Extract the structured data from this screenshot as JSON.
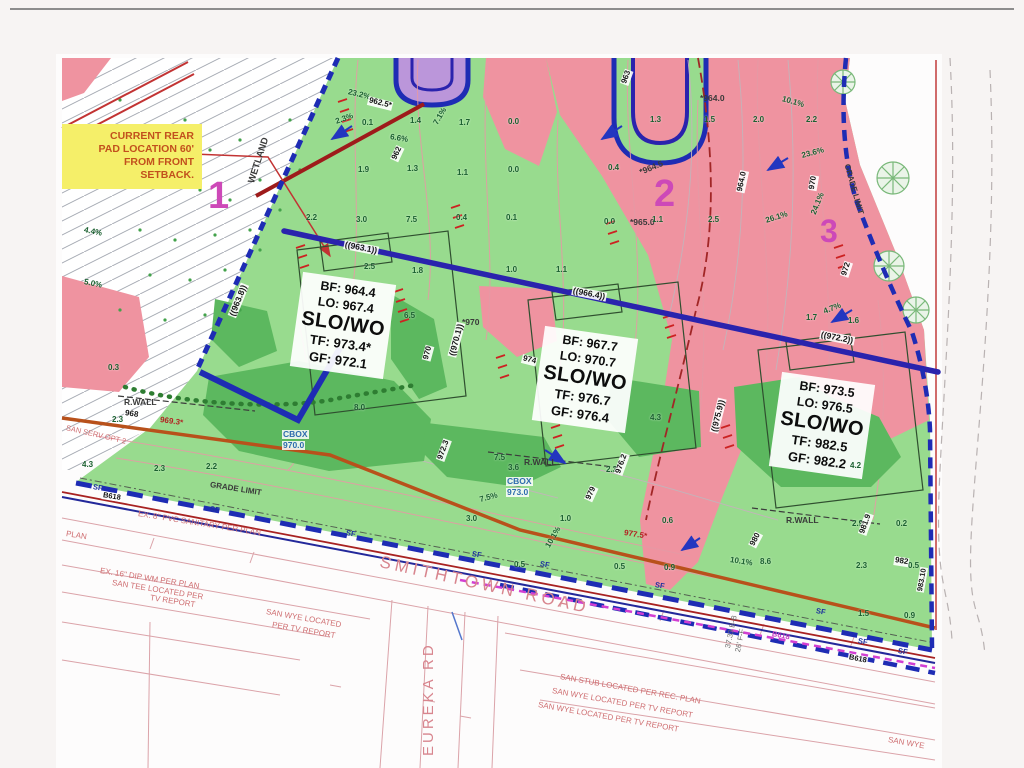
{
  "callout": {
    "lines": [
      "CURRENT REAR",
      "PAD LOCATION 60'",
      "FROM FRONT",
      "SETBACK."
    ]
  },
  "roads": {
    "smithtown": "SMITHTOWN ROAD",
    "eureka": "EUREKA RD"
  },
  "pads": [
    {
      "bf": "BF: 964.4",
      "lo": "LO: 967.4",
      "slo": "SLO/WO",
      "tf": "TF: 973.4*",
      "gf": "GF: 972.1"
    },
    {
      "bf": "BF: 967.7",
      "lo": "LO: 970.7",
      "slo": "SLO/WO",
      "tf": "TF: 976.7",
      "gf": "GF: 976.4"
    },
    {
      "bf": "BF: 973.5",
      "lo": "LO: 976.5",
      "slo": "SLO/WO",
      "tf": "TF: 982.5",
      "gf": "GF: 982.2"
    }
  ],
  "colors": {
    "site_green": "#98db8e",
    "cut_fill_pink": "#ef93a0",
    "boundary_blue": "#1e2cb4",
    "callout_yellow": "#f5ef69",
    "lot_magenta": "#cd49b8",
    "road_pink": "#d8858e"
  },
  "annotations": [
    {
      "t": "WETLAND",
      "x": 252,
      "y": 178,
      "r": -72,
      "c": "dark",
      "s": 9.5
    },
    {
      "t": "4.4%",
      "x": 84,
      "y": 226,
      "r": 12,
      "c": "num"
    },
    {
      "t": "5.0%",
      "x": 84,
      "y": 278,
      "r": 12,
      "c": "num"
    },
    {
      "t": "23.2%",
      "x": 348,
      "y": 88,
      "r": 14,
      "c": "num"
    },
    {
      "t": "962.5*",
      "x": 368,
      "y": 96,
      "r": 14,
      "c": "white"
    },
    {
      "t": "2.3%",
      "x": 336,
      "y": 118,
      "r": -20,
      "c": "num"
    },
    {
      "t": "0.1",
      "x": 362,
      "y": 119,
      "c": "num"
    },
    {
      "t": "1.4",
      "x": 410,
      "y": 117,
      "c": "num"
    },
    {
      "t": "7.1%",
      "x": 436,
      "y": 120,
      "r": -60,
      "c": "num"
    },
    {
      "t": "1.7",
      "x": 459,
      "y": 119,
      "c": "num"
    },
    {
      "t": "6.6%",
      "x": 390,
      "y": 133,
      "r": 10,
      "c": "num"
    },
    {
      "t": "962",
      "x": 394,
      "y": 156,
      "r": -65,
      "c": "white"
    },
    {
      "t": "1.9",
      "x": 358,
      "y": 166,
      "c": "num"
    },
    {
      "t": "1.3",
      "x": 407,
      "y": 165,
      "c": "num"
    },
    {
      "t": "1.1",
      "x": 457,
      "y": 169,
      "c": "num"
    },
    {
      "t": "0.0",
      "x": 508,
      "y": 118,
      "c": "num"
    },
    {
      "t": "0.0",
      "x": 508,
      "y": 166,
      "c": "num"
    },
    {
      "t": "1",
      "x": 208,
      "y": 176,
      "c": "lot",
      "s": 38
    },
    {
      "t": "963",
      "x": 624,
      "y": 80,
      "r": -70,
      "c": "white"
    },
    {
      "t": "*964.0",
      "x": 700,
      "y": 94,
      "c": "dark"
    },
    {
      "t": "10.1%",
      "x": 782,
      "y": 95,
      "r": 16,
      "c": "num"
    },
    {
      "t": "1.3",
      "x": 650,
      "y": 116,
      "c": "num"
    },
    {
      "t": "1.5",
      "x": 704,
      "y": 116,
      "c": "num"
    },
    {
      "t": "2.0",
      "x": 753,
      "y": 116,
      "c": "num"
    },
    {
      "t": "2.2",
      "x": 806,
      "y": 116,
      "c": "num"
    },
    {
      "t": "*964.5",
      "x": 640,
      "y": 168,
      "r": -22,
      "c": "dark"
    },
    {
      "t": "964.0",
      "x": 740,
      "y": 188,
      "r": -78,
      "c": "white"
    },
    {
      "t": "970",
      "x": 812,
      "y": 186,
      "r": -80,
      "c": "white"
    },
    {
      "t": "23.6%",
      "x": 802,
      "y": 152,
      "r": -15,
      "c": "num"
    },
    {
      "t": "0.4",
      "x": 608,
      "y": 164,
      "c": "num"
    },
    {
      "t": "2",
      "x": 654,
      "y": 174,
      "c": "lot",
      "s": 38
    },
    {
      "t": "*965.0",
      "x": 630,
      "y": 218,
      "c": "dark"
    },
    {
      "t": "0.0",
      "x": 604,
      "y": 218,
      "c": "num"
    },
    {
      "t": "1.1",
      "x": 652,
      "y": 216,
      "c": "num"
    },
    {
      "t": "2.5",
      "x": 708,
      "y": 216,
      "c": "num"
    },
    {
      "t": "26.1%",
      "x": 766,
      "y": 217,
      "r": -18,
      "c": "num"
    },
    {
      "t": "24.1%",
      "x": 814,
      "y": 210,
      "r": -68,
      "c": "num"
    },
    {
      "t": "3",
      "x": 820,
      "y": 214,
      "c": "lot",
      "s": 32
    },
    {
      "t": "972",
      "x": 844,
      "y": 272,
      "r": -72,
      "c": "white"
    },
    {
      "t": "GRADE LIMIT",
      "x": 846,
      "y": 160,
      "r": 74,
      "c": "dark",
      "s": 8
    },
    {
      "t": "2.2",
      "x": 306,
      "y": 214,
      "c": "num"
    },
    {
      "t": "3.0",
      "x": 356,
      "y": 216,
      "c": "num"
    },
    {
      "t": "7.5",
      "x": 406,
      "y": 216,
      "c": "num"
    },
    {
      "t": "0.4",
      "x": 456,
      "y": 214,
      "c": "num"
    },
    {
      "t": "0.1",
      "x": 506,
      "y": 214,
      "c": "num"
    },
    {
      "t": "((963.1))",
      "x": 344,
      "y": 240,
      "r": 11,
      "c": "white",
      "s": 8.5
    },
    {
      "t": "2.5",
      "x": 364,
      "y": 263,
      "c": "num"
    },
    {
      "t": "1.8",
      "x": 412,
      "y": 267,
      "c": "num"
    },
    {
      "t": "1.0",
      "x": 506,
      "y": 266,
      "c": "num"
    },
    {
      "t": "1.1",
      "x": 556,
      "y": 266,
      "c": "num"
    },
    {
      "t": "((966.4))",
      "x": 572,
      "y": 286,
      "r": 11,
      "c": "white",
      "s": 8.5
    },
    {
      "t": "((972.2))",
      "x": 820,
      "y": 330,
      "r": 11,
      "c": "white",
      "s": 8.5
    },
    {
      "t": "1.7",
      "x": 806,
      "y": 314,
      "c": "num"
    },
    {
      "t": "1.6",
      "x": 848,
      "y": 317,
      "c": "num"
    },
    {
      "t": "4.7%",
      "x": 824,
      "y": 308,
      "r": -22,
      "c": "num"
    },
    {
      "t": "((963.8))",
      "x": 232,
      "y": 312,
      "r": -68,
      "c": "white",
      "s": 8.5
    },
    {
      "t": "0.3",
      "x": 108,
      "y": 364,
      "c": "num"
    },
    {
      "t": "R.WALL",
      "x": 124,
      "y": 398,
      "c": "dark"
    },
    {
      "t": "968",
      "x": 124,
      "y": 409,
      "r": 8,
      "c": "white"
    },
    {
      "t": "969.3*",
      "x": 160,
      "y": 416,
      "r": 8,
      "c": "red"
    },
    {
      "t": "2.3",
      "x": 112,
      "y": 416,
      "c": "num"
    },
    {
      "t": "SAN SERV OPT 2",
      "x": 66,
      "y": 424,
      "r": 13,
      "c": "ann",
      "s": 7.5
    },
    {
      "t": "6.5",
      "x": 404,
      "y": 312,
      "c": "num"
    },
    {
      "t": "8.0",
      "x": 354,
      "y": 404,
      "c": "num"
    },
    {
      "t": "*970",
      "x": 462,
      "y": 318,
      "c": "dark"
    },
    {
      "t": "970",
      "x": 426,
      "y": 356,
      "r": -75,
      "c": "white"
    },
    {
      "t": "((970.1))",
      "x": 452,
      "y": 352,
      "r": -75,
      "c": "white",
      "s": 8.5
    },
    {
      "t": "974",
      "x": 522,
      "y": 354,
      "r": 14,
      "c": "white"
    },
    {
      "t": "972.3",
      "x": 440,
      "y": 456,
      "r": -70,
      "c": "white"
    },
    {
      "t": "7.5",
      "x": 494,
      "y": 454,
      "c": "num"
    },
    {
      "t": "3.6",
      "x": 508,
      "y": 464,
      "c": "num"
    },
    {
      "t": "R.WALL",
      "x": 524,
      "y": 458,
      "c": "dark"
    },
    {
      "t": "2.3",
      "x": 606,
      "y": 466,
      "c": "num"
    },
    {
      "t": "CBOX",
      "x": 282,
      "y": 430,
      "c": "blue"
    },
    {
      "t": "970.0",
      "x": 282,
      "y": 441,
      "c": "blue"
    },
    {
      "t": "CBOX",
      "x": 506,
      "y": 477,
      "c": "blue"
    },
    {
      "t": "973.0",
      "x": 506,
      "y": 488,
      "c": "blue"
    },
    {
      "t": "7.5%",
      "x": 480,
      "y": 496,
      "r": -15,
      "c": "num"
    },
    {
      "t": "2.2",
      "x": 206,
      "y": 463,
      "c": "num"
    },
    {
      "t": "2.3",
      "x": 154,
      "y": 465,
      "c": "num"
    },
    {
      "t": "4.3",
      "x": 82,
      "y": 461,
      "c": "num"
    },
    {
      "t": "GRADE LIMIT",
      "x": 210,
      "y": 481,
      "r": 9,
      "c": "dark",
      "s": 8
    },
    {
      "t": "B618",
      "x": 102,
      "y": 491,
      "r": 9,
      "c": "white",
      "s": 7.5
    },
    {
      "t": "B618",
      "x": 848,
      "y": 653,
      "r": 11,
      "c": "white",
      "s": 7.5
    },
    {
      "t": "B618",
      "x": 772,
      "y": 630,
      "r": 11,
      "c": "mag",
      "s": 7.5
    },
    {
      "t": "SF",
      "x": 93,
      "y": 483,
      "r": 10,
      "c": "sf"
    },
    {
      "t": "SF",
      "x": 210,
      "y": 505,
      "r": 10,
      "c": "sf"
    },
    {
      "t": "SF",
      "x": 346,
      "y": 529,
      "r": 10,
      "c": "sf"
    },
    {
      "t": "SF",
      "x": 472,
      "y": 550,
      "r": 10,
      "c": "sf"
    },
    {
      "t": "SF",
      "x": 540,
      "y": 560,
      "r": 10,
      "c": "sf"
    },
    {
      "t": "SF",
      "x": 655,
      "y": 581,
      "r": 10,
      "c": "sf"
    },
    {
      "t": "SF",
      "x": 816,
      "y": 607,
      "r": 10,
      "c": "sf"
    },
    {
      "t": "SF",
      "x": 858,
      "y": 637,
      "r": 10,
      "c": "sf"
    },
    {
      "t": "SF",
      "x": 898,
      "y": 647,
      "r": 10,
      "c": "sf"
    },
    {
      "t": "3.0",
      "x": 466,
      "y": 515,
      "c": "num"
    },
    {
      "t": "1.0",
      "x": 560,
      "y": 515,
      "c": "num"
    },
    {
      "t": "0.6",
      "x": 662,
      "y": 517,
      "c": "num"
    },
    {
      "t": "0.5",
      "x": 514,
      "y": 561,
      "c": "num"
    },
    {
      "t": "0.5",
      "x": 614,
      "y": 563,
      "c": "num"
    },
    {
      "t": "0.9",
      "x": 664,
      "y": 564,
      "c": "num"
    },
    {
      "t": "10.1%",
      "x": 548,
      "y": 543,
      "r": -60,
      "c": "num"
    },
    {
      "t": "979",
      "x": 588,
      "y": 496,
      "r": -65,
      "c": "white"
    },
    {
      "t": "976.2",
      "x": 618,
      "y": 470,
      "r": -70,
      "c": "white"
    },
    {
      "t": "977.5*",
      "x": 624,
      "y": 529,
      "r": 9,
      "c": "red"
    },
    {
      "t": "4.3",
      "x": 650,
      "y": 414,
      "c": "num"
    },
    {
      "t": "4.2",
      "x": 850,
      "y": 462,
      "c": "num"
    },
    {
      "t": "R.WALL",
      "x": 786,
      "y": 516,
      "c": "dark"
    },
    {
      "t": "2.9",
      "x": 852,
      "y": 520,
      "c": "num"
    },
    {
      "t": "0.2",
      "x": 896,
      "y": 520,
      "c": "num"
    },
    {
      "t": "2.3",
      "x": 856,
      "y": 562,
      "c": "num"
    },
    {
      "t": "0.5",
      "x": 908,
      "y": 562,
      "c": "num"
    },
    {
      "t": "1.5",
      "x": 858,
      "y": 610,
      "c": "num"
    },
    {
      "t": "0.9",
      "x": 904,
      "y": 612,
      "c": "num"
    },
    {
      "t": "10.1%",
      "x": 730,
      "y": 556,
      "r": 9,
      "c": "num"
    },
    {
      "t": "8.6",
      "x": 760,
      "y": 558,
      "c": "num"
    },
    {
      "t": "980",
      "x": 752,
      "y": 542,
      "r": -62,
      "c": "white"
    },
    {
      "t": "981.9",
      "x": 862,
      "y": 530,
      "r": -70,
      "c": "white"
    },
    {
      "t": "982",
      "x": 894,
      "y": 556,
      "r": 9,
      "c": "white"
    },
    {
      "t": "((975.9))",
      "x": 714,
      "y": 428,
      "r": -76,
      "c": "white",
      "s": 8.5
    },
    {
      "t": "983.10",
      "x": 920,
      "y": 588,
      "r": -80,
      "c": "white",
      "s": 7.5
    },
    {
      "t": "37.33 B-B",
      "x": 728,
      "y": 644,
      "r": -78,
      "c": "gray"
    },
    {
      "t": "26' F-F",
      "x": 738,
      "y": 648,
      "r": -78,
      "c": "gray"
    },
    {
      "t": "EX. 8\" PVC SANITARY PER PLAN",
      "x": 138,
      "y": 510,
      "r": 9,
      "c": "ann"
    },
    {
      "t": "PLAN",
      "x": 66,
      "y": 530,
      "r": 9,
      "c": "ann"
    },
    {
      "t": "EX. 16\" DIP WM PER PLAN",
      "x": 100,
      "y": 567,
      "r": 9,
      "c": "ann"
    },
    {
      "t": "SAN TEE LOCATED PER",
      "x": 112,
      "y": 579,
      "r": 9,
      "c": "ann"
    },
    {
      "t": "TV REPORT",
      "x": 150,
      "y": 594,
      "r": 9,
      "c": "ann"
    },
    {
      "t": "SAN WYE LOCATED",
      "x": 266,
      "y": 608,
      "r": 10,
      "c": "ann"
    },
    {
      "t": "PER TV REPORT",
      "x": 272,
      "y": 621,
      "r": 10,
      "c": "ann"
    },
    {
      "t": "SAN STUB LOCATED PER REC. PLAN",
      "x": 560,
      "y": 673,
      "r": 10,
      "c": "ann"
    },
    {
      "t": "SAN WYE LOCATED PER TV REPORT",
      "x": 552,
      "y": 687,
      "r": 10,
      "c": "ann"
    },
    {
      "t": "SAN WYE LOCATED PER TV REPORT",
      "x": 538,
      "y": 701,
      "r": 10,
      "c": "ann"
    },
    {
      "t": "SAN WYE",
      "x": 888,
      "y": 736,
      "r": 10,
      "c": "ann"
    }
  ]
}
